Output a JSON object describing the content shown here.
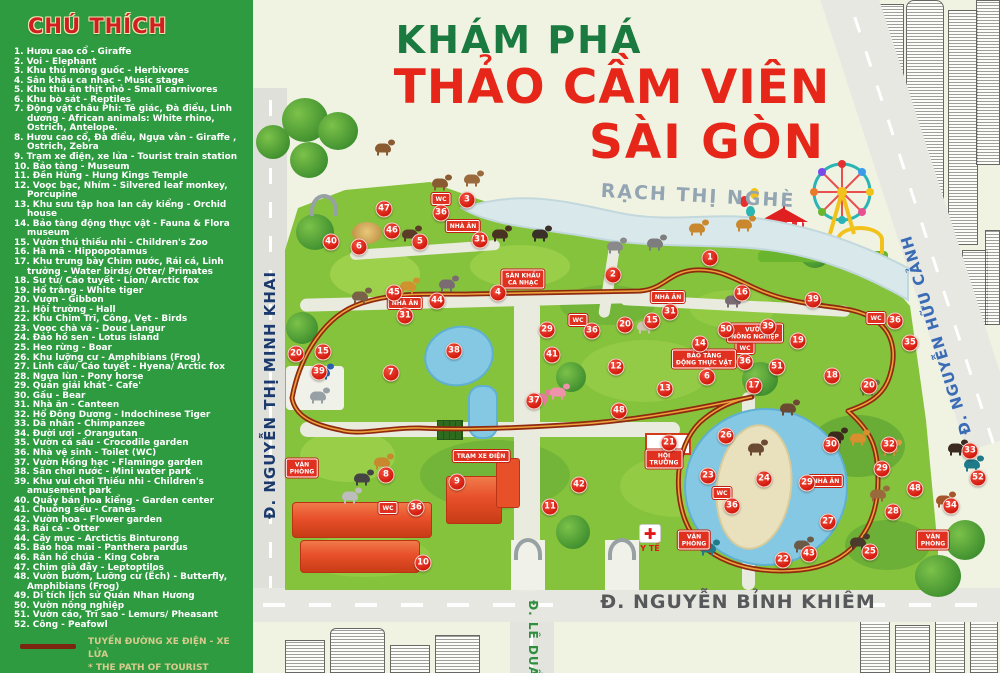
{
  "legend": {
    "title": "CHÚ THÍCH",
    "items": [
      "1. Hươu cao cổ - Giraffe",
      "2. Voi - Elephant",
      "3. Khu thú móng guốc - Herbivores",
      "4. Sân khấu ca nhạc - Music stage",
      "5. Khu thú ăn thịt nhỏ - Small carnivores",
      "6. Khu bò sát - Reptiles",
      "7. Động vật châu Phi: Tê giác, Đà điểu, Linh dương - African animals: White rhino, Ostrich, Antelope.",
      "8. Hươu cao cổ, Đà điểu, Ngựa vằn - Giraffe , Ostrich, Zebra",
      "9. Trạm xe điện, xe lửa - Tourist train station",
      "10. Bảo tàng - Museum",
      "11. Đền Hùng - Hung Kings Temple",
      "12. Voọc bạc, Nhím - Silvered leaf monkey, Porcupine",
      "13. Khu sưu tập hoa lan cây kiểng - Orchid house",
      "14. Bảo tàng động thực vật - Fauna & Flora museum",
      "15. Vườn thú thiếu nhi - Children's Zoo",
      "16. Hà mã - Hippopotamus",
      "17. Khu trưng bày Chim nước, Rái cá, Linh trưởng - Water birds/ Otter/ Primates",
      "18. Sư tử/ Cáo tuyết - Lion/ Arctic fox",
      "19. Hổ trắng - White tiger",
      "20. Vượn - Gibbon",
      "21. Hội trường - Hall",
      "22. Khu Chim Trĩ, Công, Vẹt - Birds",
      "23. Voọc chà vá - Douc Langur",
      "24. Đảo hồ sen - Lotus island",
      "25. Heo rừng - Boar",
      "26. Khu lưỡng cư - Amphibians (Frog)",
      "27. Linh cẩu/ Cáo tuyết - Hyena/ Arctic fox",
      "28. Ngựa lùn - Pony horse",
      "29. Quán giải khát - Cafe'",
      "30. Gấu - Bear",
      "31. Nhà ăn - Canteen",
      "32. Hổ Đông Dương - Indochinese Tiger",
      "33. Dã nhân - Chimpanzee",
      "34. Đười ươi - Orangutan",
      "35. Vườn cá sấu - Crocodile garden",
      "36. Nhà vệ sinh - Toilet (WC)",
      "37. Vườn Hồng hạc - Flamingo garden",
      "38. Sân chơi nước - Mini water park",
      "39. Khu vui chơi Thiếu nhi - Children's amusement park",
      "40. Quầy bán hoa kiểng - Garden center",
      "41. Chuồng sếu - Cranes",
      "42. Vườn hoa - Flower garden",
      "43. Rái cá - Otter",
      "44. Cây mực - Arctictis Binturong",
      "45. Báo hoa mai - Panthera pardus",
      "46. Rắn hổ chúa - King Cobra",
      "47. Chim già đẫy - Leptoptilos",
      "48. Vườn bướm, Lưỡng cư (Ếch) - Butterfly, Amphibians (Frog)",
      "49. Di tích lịch sử Quán Nhan Hương",
      "50. Vườn nông nghiệp",
      "51. Vườn cáo, Trĩ sao - Lemurs/ Pheasant",
      "52. Công - Peafowl"
    ],
    "train_legend_line1": "TUYẾN ĐƯỜNG XE ĐIỆN - XE LỬA",
    "train_legend_line2": "* THE PATH OF TOURIST TRAINS"
  },
  "title": {
    "line1": "KHÁM PHÁ",
    "line2": "THẢO CẦM VIÊN",
    "line3": "SÀI GÒN"
  },
  "map": {
    "river_label": "RẠCH THỊ NGHÈ",
    "streets": [
      {
        "id": "minh-khai",
        "label": "Đ. NGUYỄN THỊ MINH KHAI"
      },
      {
        "id": "huu-canh",
        "label": "Đ. NGUYỄN HỮU CẢNH"
      },
      {
        "id": "binh-khiem",
        "label": "Đ. NGUYỄN BỈNH KHIÊM"
      },
      {
        "id": "le-duan",
        "label": "Đ. LÊ DUẨN"
      }
    ],
    "medical_label": "Y TẾ",
    "medical_cross": "✚",
    "markers": [
      {
        "n": "1",
        "x": 710,
        "y": 258
      },
      {
        "n": "2",
        "x": 613,
        "y": 275
      },
      {
        "n": "3",
        "x": 467,
        "y": 200
      },
      {
        "n": "4",
        "x": 498,
        "y": 293
      },
      {
        "n": "5",
        "x": 420,
        "y": 242
      },
      {
        "n": "6",
        "x": 359,
        "y": 247
      },
      {
        "n": "6",
        "x": 707,
        "y": 377
      },
      {
        "n": "7",
        "x": 391,
        "y": 373
      },
      {
        "n": "8",
        "x": 386,
        "y": 475
      },
      {
        "n": "9",
        "x": 457,
        "y": 482
      },
      {
        "n": "10",
        "x": 423,
        "y": 563
      },
      {
        "n": "11",
        "x": 550,
        "y": 507
      },
      {
        "n": "12",
        "x": 616,
        "y": 367
      },
      {
        "n": "13",
        "x": 665,
        "y": 389
      },
      {
        "n": "14",
        "x": 700,
        "y": 344
      },
      {
        "n": "15",
        "x": 652,
        "y": 321
      },
      {
        "n": "15",
        "x": 323,
        "y": 352
      },
      {
        "n": "16",
        "x": 742,
        "y": 293
      },
      {
        "n": "17",
        "x": 754,
        "y": 386
      },
      {
        "n": "18",
        "x": 832,
        "y": 376
      },
      {
        "n": "19",
        "x": 798,
        "y": 341
      },
      {
        "n": "20",
        "x": 625,
        "y": 325
      },
      {
        "n": "20",
        "x": 296,
        "y": 354
      },
      {
        "n": "20",
        "x": 869,
        "y": 386
      },
      {
        "n": "21",
        "x": 669,
        "y": 443
      },
      {
        "n": "22",
        "x": 783,
        "y": 560
      },
      {
        "n": "23",
        "x": 708,
        "y": 476
      },
      {
        "n": "24",
        "x": 764,
        "y": 479
      },
      {
        "n": "25",
        "x": 870,
        "y": 552
      },
      {
        "n": "26",
        "x": 726,
        "y": 436
      },
      {
        "n": "27",
        "x": 828,
        "y": 522
      },
      {
        "n": "28",
        "x": 893,
        "y": 512
      },
      {
        "n": "29",
        "x": 547,
        "y": 330
      },
      {
        "n": "29",
        "x": 807,
        "y": 483
      },
      {
        "n": "29",
        "x": 882,
        "y": 469
      },
      {
        "n": "30",
        "x": 831,
        "y": 445
      },
      {
        "n": "31",
        "x": 480,
        "y": 240
      },
      {
        "n": "31",
        "x": 405,
        "y": 316
      },
      {
        "n": "31",
        "x": 670,
        "y": 312
      },
      {
        "n": "32",
        "x": 889,
        "y": 445
      },
      {
        "n": "33",
        "x": 970,
        "y": 451
      },
      {
        "n": "34",
        "x": 951,
        "y": 506
      },
      {
        "n": "35",
        "x": 910,
        "y": 343
      },
      {
        "n": "36",
        "x": 441,
        "y": 213
      },
      {
        "n": "36",
        "x": 592,
        "y": 331
      },
      {
        "n": "36",
        "x": 745,
        "y": 362
      },
      {
        "n": "36",
        "x": 416,
        "y": 508
      },
      {
        "n": "36",
        "x": 895,
        "y": 321
      },
      {
        "n": "36",
        "x": 732,
        "y": 506
      },
      {
        "n": "37",
        "x": 534,
        "y": 401
      },
      {
        "n": "38",
        "x": 454,
        "y": 351
      },
      {
        "n": "39",
        "x": 319,
        "y": 372
      },
      {
        "n": "39",
        "x": 813,
        "y": 300
      },
      {
        "n": "39",
        "x": 768,
        "y": 327
      },
      {
        "n": "40",
        "x": 331,
        "y": 242
      },
      {
        "n": "41",
        "x": 552,
        "y": 355
      },
      {
        "n": "42",
        "x": 579,
        "y": 485
      },
      {
        "n": "43",
        "x": 809,
        "y": 554
      },
      {
        "n": "44",
        "x": 437,
        "y": 301
      },
      {
        "n": "45",
        "x": 394,
        "y": 293
      },
      {
        "n": "46",
        "x": 392,
        "y": 231
      },
      {
        "n": "47",
        "x": 384,
        "y": 209
      },
      {
        "n": "48",
        "x": 619,
        "y": 411
      },
      {
        "n": "48",
        "x": 915,
        "y": 489
      },
      {
        "n": "50",
        "x": 726,
        "y": 330
      },
      {
        "n": "51",
        "x": 777,
        "y": 367
      },
      {
        "n": "52",
        "x": 978,
        "y": 478
      }
    ],
    "signs": [
      {
        "text": "NHÀ ĂN",
        "x": 463,
        "y": 226
      },
      {
        "text": "NHÀ ĂN",
        "x": 405,
        "y": 303
      },
      {
        "text": "NHÀ ĂN",
        "x": 668,
        "y": 297
      },
      {
        "text": "NHÀ ĂN",
        "x": 826,
        "y": 481
      },
      {
        "text": "WC",
        "x": 441,
        "y": 199
      },
      {
        "text": "WC",
        "x": 578,
        "y": 320
      },
      {
        "text": "WC",
        "x": 745,
        "y": 348
      },
      {
        "text": "WC",
        "x": 388,
        "y": 508
      },
      {
        "text": "WC",
        "x": 876,
        "y": 318
      },
      {
        "text": "WC",
        "x": 722,
        "y": 493
      },
      {
        "text": "VĂN\nPHÒNG",
        "x": 302,
        "y": 468
      },
      {
        "text": "VĂN\nPHÒNG",
        "x": 694,
        "y": 540
      },
      {
        "text": "VĂN\nPHÒNG",
        "x": 933,
        "y": 540
      },
      {
        "text": "SÂN KHẤU\nCA NHẠC",
        "x": 523,
        "y": 279
      },
      {
        "text": "TRẠM XE ĐIỆN",
        "x": 481,
        "y": 456
      },
      {
        "text": "HỘI\nTRƯỜNG",
        "x": 664,
        "y": 459
      },
      {
        "text": "BẢO TÀNG\nĐỘNG THỰC VẬT",
        "x": 704,
        "y": 359
      },
      {
        "text": "VƯỜN\nNÔNG NGHIỆP",
        "x": 755,
        "y": 333
      }
    ],
    "animals": [
      {
        "name": "deer",
        "x": 440,
        "y": 183,
        "c": "#8a5a30"
      },
      {
        "name": "deer",
        "x": 472,
        "y": 179,
        "c": "#9b6a3c"
      },
      {
        "name": "deer",
        "x": 383,
        "y": 148,
        "c": "#8a5a30"
      },
      {
        "name": "wildebeest",
        "x": 540,
        "y": 234,
        "c": "#3a3028"
      },
      {
        "name": "elephant",
        "x": 615,
        "y": 246,
        "c": "#8a8a8a"
      },
      {
        "name": "elephant",
        "x": 655,
        "y": 243,
        "c": "#7d7d7d"
      },
      {
        "name": "giraffe",
        "x": 697,
        "y": 228,
        "c": "#c9882e"
      },
      {
        "name": "giraffe",
        "x": 744,
        "y": 224,
        "c": "#c9882e"
      },
      {
        "name": "giraffe",
        "x": 382,
        "y": 462,
        "c": "#c9882e"
      },
      {
        "name": "zebra",
        "x": 350,
        "y": 496,
        "c": "#bdbdbd"
      },
      {
        "name": "ostrich",
        "x": 362,
        "y": 478,
        "c": "#444444"
      },
      {
        "name": "hippo",
        "x": 447,
        "y": 284,
        "c": "#7a6a72"
      },
      {
        "name": "hippo",
        "x": 733,
        "y": 300,
        "c": "#7a6a72"
      },
      {
        "name": "rhino",
        "x": 318,
        "y": 396,
        "c": "#97a0a5"
      },
      {
        "name": "bear",
        "x": 410,
        "y": 234,
        "c": "#5a3c28"
      },
      {
        "name": "bear",
        "x": 500,
        "y": 234,
        "c": "#4a3222"
      },
      {
        "name": "bear",
        "x": 836,
        "y": 436,
        "c": "#3c2a1c"
      },
      {
        "name": "hyena",
        "x": 360,
        "y": 296,
        "c": "#7a6248"
      },
      {
        "name": "leopard",
        "x": 408,
        "y": 286,
        "c": "#d0922e"
      },
      {
        "name": "flamingo",
        "x": 540,
        "y": 398,
        "c": "#e87a9a"
      },
      {
        "name": "flamingo",
        "x": 558,
        "y": 392,
        "c": "#ef93ab"
      },
      {
        "name": "peacock",
        "x": 708,
        "y": 548,
        "c": "#1f7a8a"
      },
      {
        "name": "peacock",
        "x": 972,
        "y": 464,
        "c": "#1f7a8a"
      },
      {
        "name": "monkey",
        "x": 788,
        "y": 408,
        "c": "#6b4a33"
      },
      {
        "name": "monkey",
        "x": 756,
        "y": 448,
        "c": "#6b4a33"
      },
      {
        "name": "chimpanzee",
        "x": 956,
        "y": 448,
        "c": "#3a2a20"
      },
      {
        "name": "orangutan",
        "x": 944,
        "y": 500,
        "c": "#a5562a"
      },
      {
        "name": "tiger",
        "x": 858,
        "y": 438,
        "c": "#d98f2e"
      },
      {
        "name": "tiger",
        "x": 890,
        "y": 448,
        "c": "#e09a38"
      },
      {
        "name": "crocodile",
        "x": 868,
        "y": 388,
        "c": "#5f7a3a"
      },
      {
        "name": "otter",
        "x": 802,
        "y": 545,
        "c": "#6b5a48"
      },
      {
        "name": "boar",
        "x": 858,
        "y": 542,
        "c": "#4a3a2c"
      },
      {
        "name": "goat",
        "x": 645,
        "y": 326,
        "c": "#cfc4b0"
      },
      {
        "name": "deer",
        "x": 878,
        "y": 494,
        "c": "#9b6a3c"
      },
      {
        "name": "tourist-train",
        "x": 322,
        "y": 372,
        "c": "#2a5fae"
      }
    ]
  },
  "colors": {
    "sidebar_green": "#2e9b41",
    "title_green": "#1a7a40",
    "title_red": "#e62619",
    "marker_red": "#d31a0e",
    "park_green": "#86c33d",
    "river_blue": "#d9e8ea",
    "road_gray": "#e4e5df",
    "train_path_red": "#8f2a10",
    "street_navy": "#1c3a6e",
    "street_blue": "#3a6cb5",
    "street_gray": "#57585a",
    "street_green": "#2f8f3f"
  }
}
